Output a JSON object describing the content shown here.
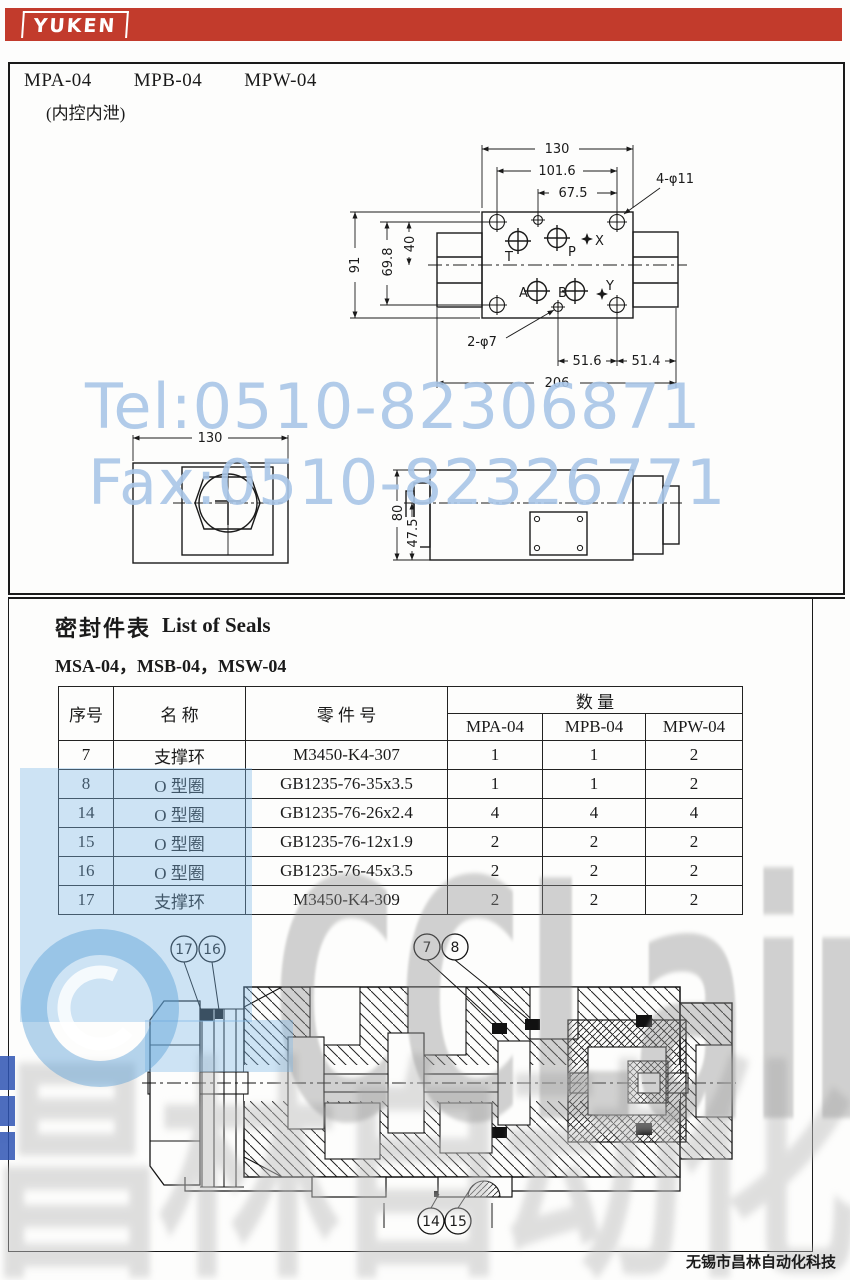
{
  "brand": {
    "logo": "YUKEN"
  },
  "page": {
    "models": [
      "MPA-04",
      "MPB-04",
      "MPW-04"
    ],
    "subtitle": "(内控内泄)"
  },
  "seals": {
    "title_cn": "密封件表",
    "title_en": "List of Seals",
    "models_line": "MSA-04，MSB-04，MSW-04",
    "table": {
      "h_no": "序号",
      "h_name": "名 称",
      "h_part": "零 件 号",
      "h_qty": "数 量",
      "h_models": [
        "MPA-04",
        "MPB-04",
        "MPW-04"
      ],
      "rows": [
        {
          "no": "7",
          "name": "支撑环",
          "part": "M3450-K4-307",
          "q": [
            "1",
            "1",
            "2"
          ]
        },
        {
          "no": "8",
          "name": "O 型圈",
          "part": "GB1235-76-35x3.5",
          "q": [
            "1",
            "1",
            "2"
          ]
        },
        {
          "no": "14",
          "name": "O 型圈",
          "part": "GB1235-76-26x2.4",
          "q": [
            "4",
            "4",
            "4"
          ]
        },
        {
          "no": "15",
          "name": "O 型圈",
          "part": "GB1235-76-12x1.9",
          "q": [
            "2",
            "2",
            "2"
          ]
        },
        {
          "no": "16",
          "name": "O 型圈",
          "part": "GB1235-76-45x3.5",
          "q": [
            "2",
            "2",
            "2"
          ]
        },
        {
          "no": "17",
          "name": "支撑环",
          "part": "M3450-K4-309",
          "q": [
            "2",
            "2",
            "2"
          ]
        }
      ]
    }
  },
  "drawings": {
    "top_view": {
      "dims": {
        "w130": "130",
        "w101": "101.6",
        "w67": "67.5",
        "holes_top": "4-φ11",
        "h91": "91",
        "h69": "69.8",
        "h40": "40",
        "holes_bottom": "2-φ7",
        "d51_6": "51.6",
        "d51_4": "51.4",
        "d206": "206"
      },
      "ports": {
        "t": "T",
        "p": "P",
        "x": "X",
        "a": "A",
        "b": "B",
        "y": "Y"
      }
    },
    "end_view": {
      "dims": {
        "w130": "130"
      }
    },
    "side_view": {
      "dims": {
        "h80": "80",
        "h47": "47.5"
      }
    },
    "section": {
      "callouts": {
        "c17": "17",
        "c16": "16",
        "c7": "7",
        "c8": "8",
        "c14": "14",
        "c15": "15"
      }
    }
  },
  "watermark": {
    "tel": "Tel:0510-82306871",
    "fax": "Fax:0510-82326771",
    "logo": "CCLair",
    "logo_cn": "昌林自动化"
  },
  "footer": {
    "company": "无锡市昌林自动化科技"
  },
  "colors": {
    "brand_red": "#c23b2c",
    "watermark_blue": "#a9c6e8",
    "line": "#1a1a1a"
  }
}
